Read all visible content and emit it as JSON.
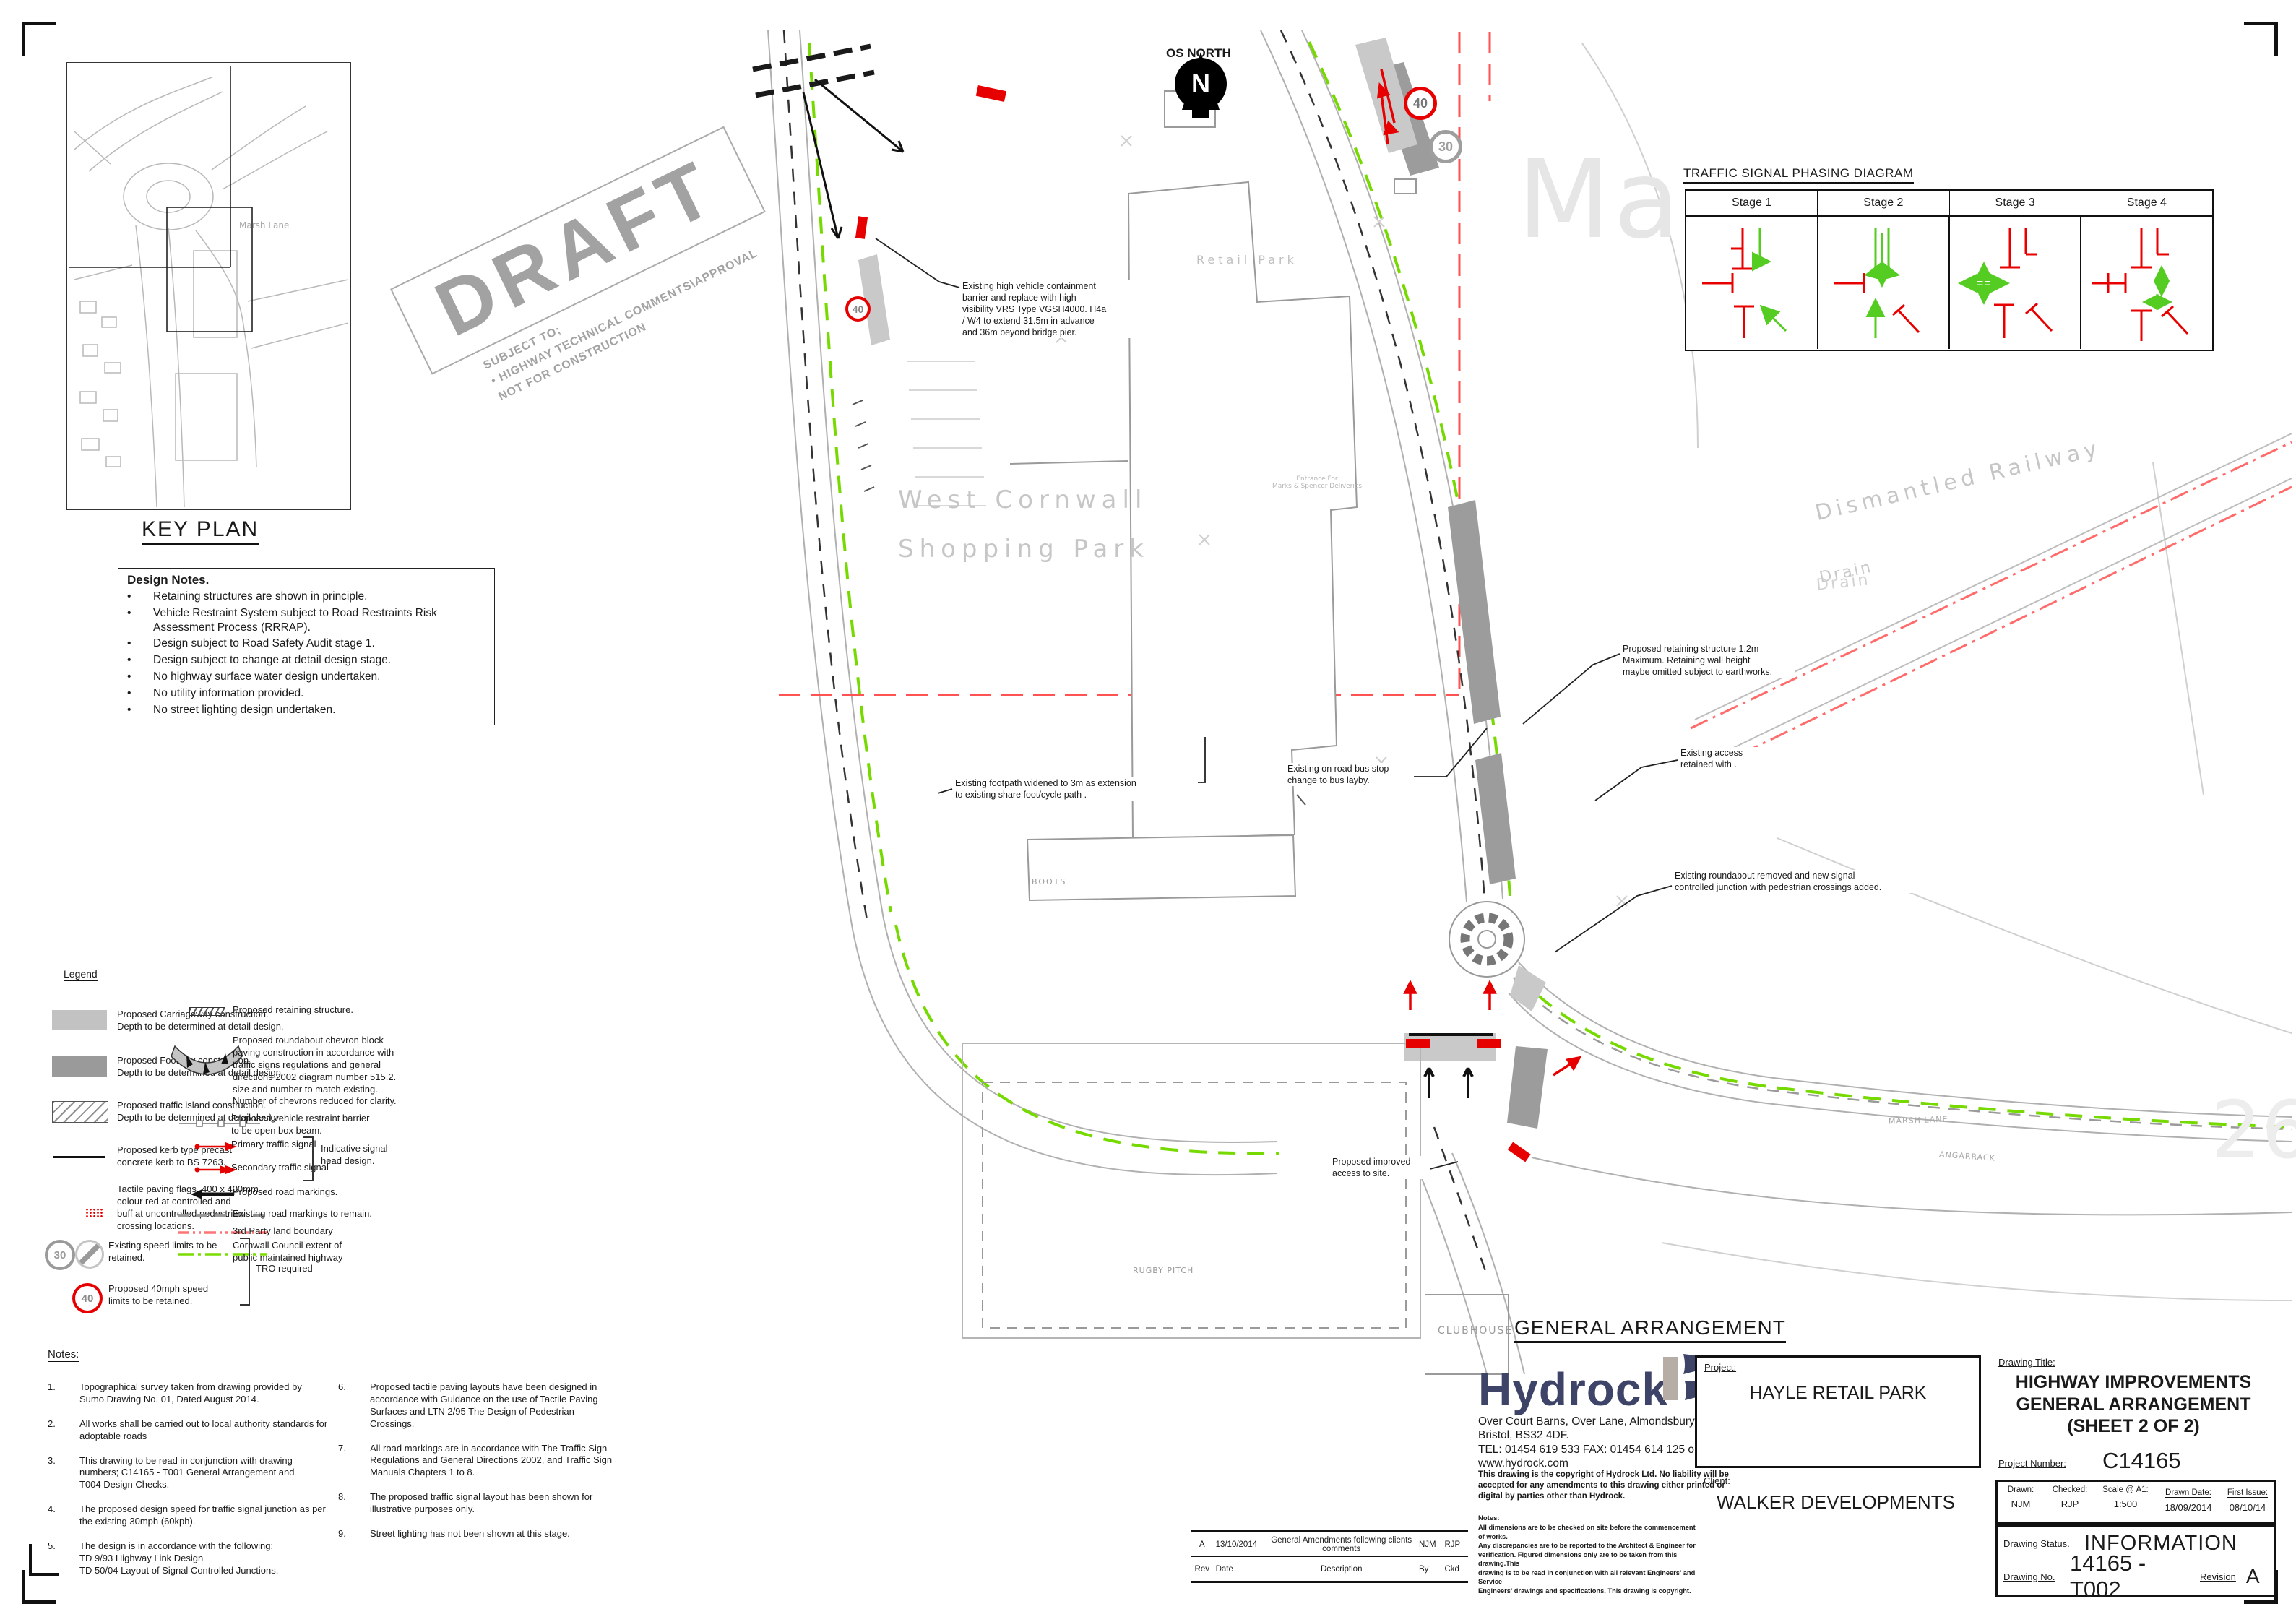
{
  "key_plan": {
    "title": "KEY PLAN",
    "marsh_lane": "Marsh Lane"
  },
  "draft": {
    "word": "DRAFT",
    "sub1": "SUBJECT TO;",
    "sub2": "•  HIGHWAY TECHNICAL COMMENTS\\APPROVAL",
    "sub3": "NOT FOR CONSTRUCTION"
  },
  "design_notes": {
    "title": "Design Notes.",
    "items": [
      "Retaining structures are shown in principle.",
      "Vehicle Restraint System subject to Road Restraints Risk Assessment Process (RRRAP).",
      "Design subject to Road Safety Audit stage 1.",
      "Design subject to change at detail design stage.",
      "No highway surface water design undertaken.",
      "No utility information provided.",
      "No street lighting design undertaken."
    ]
  },
  "legend": {
    "title": "Legend",
    "carriageway": "Proposed Carriageway construction.\nDepth to be determined at detail design.",
    "footway": "Proposed Footway construction.\nDepth to be determined at detail design.",
    "island": "Proposed traffic island construction.\nDepth to be determined at detail design.",
    "kerb": "Proposed kerb type precast\nconcrete kerb to BS 7263.",
    "tactile": "Tactile paving flags, 400 x 400mm\ncolour red at controlled and\nbuff at uncontrolled pedestrian\ncrossing locations.",
    "speed_existing": "Existing speed limits to be\nretained.",
    "tro": "TRO required",
    "speed40": "Proposed 40mph speed\nlimits to be retained.",
    "sign30": "30",
    "sign40": "40",
    "retaining": "Proposed retaining structure.",
    "chevron": "Proposed roundabout chevron block\npaving construction in accordance with\ntraffic signs regulations and general\ndirections 2002 diagram number 515.2.\nsize and number to match existing.\nNumber of chevrons reduced for clarity.",
    "barrier": "Proposed vehicle restraint barrier\nto be open box beam.",
    "primary": "Primary traffic signal",
    "secondary": "Secondary traffic signal",
    "indicative": "Indicative signal\nhead design.",
    "road_markings": "Proposed road markings.",
    "existing_markings": "Existing road markings to remain.",
    "third_party": "3rd Party land boundary",
    "cornwall": "Cornwall Council extent of\npublic maintained highway"
  },
  "notes": {
    "title": "Notes:",
    "left": [
      {
        "n": "1.",
        "t": "Topographical survey taken from drawing provided by\nSumo Drawing No. 01, Dated August 2014."
      },
      {
        "n": "2.",
        "t": "All works shall be carried out to local authority standards for\nadoptable roads"
      },
      {
        "n": "3.",
        "t": "This drawing to be read in conjunction with drawing\nnumbers; C14165 - T001 General Arrangement and\nT004 Design Checks."
      },
      {
        "n": "4.",
        "t": "The proposed design speed for traffic signal junction as per\nthe existing 30mph (60kph)."
      },
      {
        "n": "5.",
        "t": "The design is in accordance with the following;\nTD 9/93 Highway Link Design\nTD 50/04 Layout of Signal Controlled Junctions."
      }
    ],
    "right": [
      {
        "n": "6.",
        "t": "Proposed tactile paving layouts have been designed in\naccordance with Guidance on the use of Tactile Paving\nSurfaces and LTN 2/95 The Design of Pedestrian\nCrossings."
      },
      {
        "n": "7.",
        "t": "All road markings are in accordance with The Traffic Sign\nRegulations and General Directions 2002, and Traffic Sign\nManuals Chapters 1 to 8."
      },
      {
        "n": "8.",
        "t": "The proposed traffic signal layout has been shown for\nillustrative purposes only."
      },
      {
        "n": "9.",
        "t": "Street lighting has not been shown at this stage."
      }
    ]
  },
  "phasing": {
    "title": "TRAFFIC SIGNAL PHASING DIAGRAM",
    "stages": [
      "Stage 1",
      "Stage 2",
      "Stage 3",
      "Stage 4"
    ]
  },
  "plan": {
    "north": "OS NORTH",
    "north_n": "N",
    "ma": "Ma",
    "faint26": "26",
    "retail_park": "Retail Park",
    "wcsp1": "West Cornwall",
    "wcsp2": "Shopping Park",
    "boots": "BOOTS",
    "rugby": "RUGBY PITCH",
    "clubhouse": "CLUBHOUSE",
    "dismantled": "Dismantled Railway",
    "drain": "Drain",
    "marsh_lane": "MARSH LANE",
    "angarrack": "ANGARRACK",
    "entrance": "Entrance For\nMarks & Spencer Deliveries",
    "s40": "40",
    "s30": "30",
    "s40b": "40",
    "ga_label": "GENERAL ARRANGEMENT",
    "ann_vrs": "Existing high vehicle containment\nbarrier and replace with high\nvisibility VRS Type  VGSH4000. H4a\n/ W4 to extend 31.5m in advance\nand 36m beyond bridge pier.",
    "ann_footpath": "Existing footpath widened to 3m as extension\nto existing share foot/cycle path .",
    "ann_bus": "Existing on road bus stop\nchange to bus layby.",
    "ann_retaining": "Proposed retaining structure 1.2m\nMaximum. Retaining wall height\nmaybe omitted subject to earthworks.",
    "ann_access": "Existing access\nretained with .",
    "ann_roundabout": "Existing roundabout removed and new signal\ncontrolled junction with pedestrian crossings added.",
    "ann_improved": "Proposed improved\naccess to site."
  },
  "title_block": {
    "logo": "Hydrock",
    "address": "Over Court Barns, Over Lane, Almondsbury,\nBristol, BS32 4DF.\nTEL: 01454 619 533 FAX: 01454 614 125 or visit\nwww.hydrock.com",
    "copyright": "This drawing is the copyright of Hydrock Ltd. No liability will be\naccepted for any amendments to this drawing either printed or\ndigital by parties other than Hydrock.",
    "tb_notes_title": "Notes:",
    "tb_notes": "All dimensions are to be checked on site before the commencement of works.\nAny discrepancies are to be reported to the Architect & Engineer for\nverification. Figured dimensions only are to be taken from this drawing.This\ndrawing is to be read in conjunction with all relevant Engineers' and Service\nEngineers' drawings and specifications. This drawing is copyright.",
    "project_label": "Project:",
    "project": "HAYLE RETAIL PARK",
    "client_label": "Client:",
    "client": "WALKER DEVELOPMENTS",
    "drawing_title_label": "Drawing Title:",
    "drawing_title1": "HIGHWAY IMPROVEMENTS",
    "drawing_title2": "GENERAL ARRANGEMENT",
    "drawing_title3": "(SHEET 2 OF 2)",
    "project_number_label": "Project Number:",
    "project_number": "C14165",
    "drawn_label": "Drawn:",
    "drawn": "NJM",
    "checked_label": "Checked:",
    "checked": "RJP",
    "scale_label": "Scale @ A1:",
    "scale": "1:500",
    "drawn_date_label": "Drawn Date:",
    "drawn_date": "18/09/2014",
    "first_issue_label": "First Issue:",
    "first_issue": "08/10/14",
    "status_label": "Drawing Status.",
    "status": "INFORMATION",
    "drawing_no_label": "Drawing No.",
    "drawing_no": "14165 - T002",
    "revision_label": "Revision",
    "revision": "A",
    "rev_row": {
      "rev": "A",
      "date": "13/10/2014",
      "desc": "General Amendments following clients comments",
      "by": "NJM",
      "ckd": "RJP"
    },
    "rev_head": {
      "rev": "Rev",
      "date": "Date",
      "desc": "Description",
      "by": "By",
      "ckd": "Ckd"
    }
  }
}
